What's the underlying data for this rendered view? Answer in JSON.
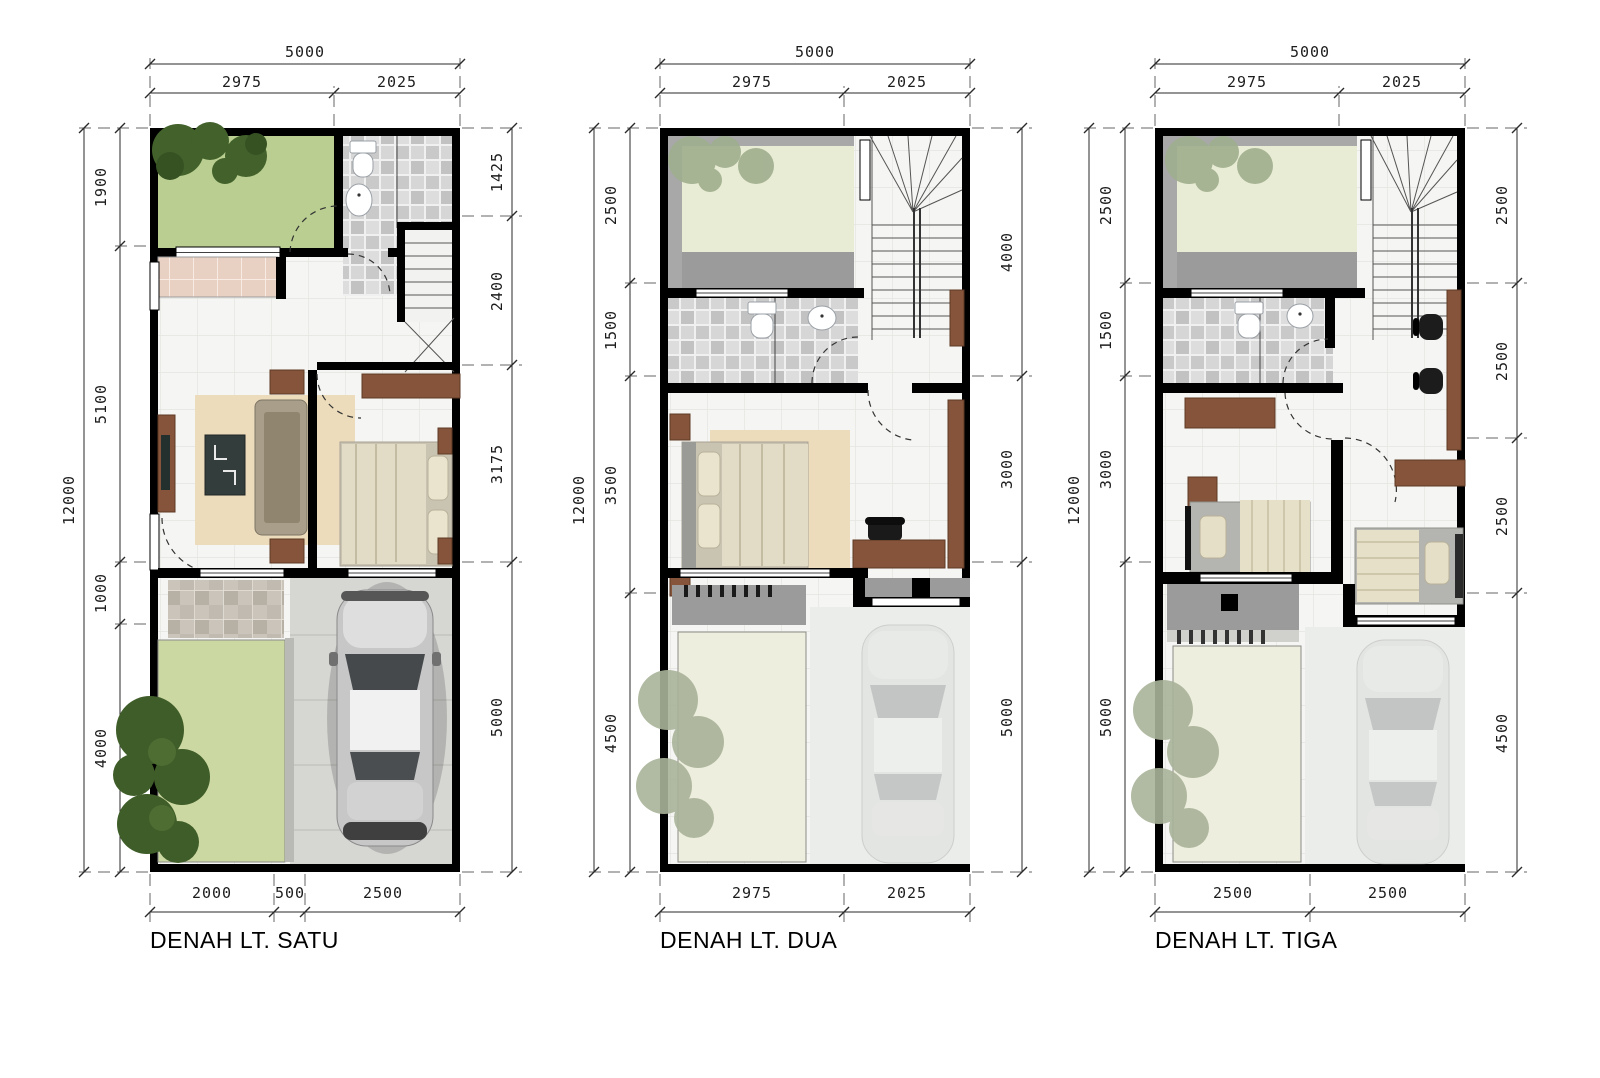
{
  "document": {
    "background": "#ffffff"
  },
  "colors": {
    "wall": "#000000",
    "dimension_line": "#2a2a2a",
    "grass": "#b9ce90",
    "grass_faded": "#e9ecd4",
    "tree": "#3f5d29",
    "tree_faded": "#a7b296",
    "wood": "#86543a",
    "carport": "#d6d7d3",
    "balcony_gray": "#9b9b9b",
    "rug": "#ecdcbb"
  },
  "plans": [
    {
      "title": "DENAH LT. SATU",
      "dims": {
        "top_total": "5000",
        "top": [
          "2975",
          "2025"
        ],
        "side_total": "12000",
        "left": [
          "1900",
          "5100",
          "1000",
          "4000"
        ],
        "right": [
          "1425",
          "2400",
          "3175",
          "5000"
        ],
        "bottom": [
          "2000",
          "500",
          "2500"
        ]
      }
    },
    {
      "title": "DENAH LT. DUA",
      "dims": {
        "top_total": "5000",
        "top": [
          "2975",
          "2025"
        ],
        "side_total": "12000",
        "left": [
          "2500",
          "1500",
          "3500",
          "4500"
        ],
        "right": [
          "4000",
          "3000",
          "5000"
        ],
        "bottom": [
          "2975",
          "2025"
        ]
      }
    },
    {
      "title": "DENAH LT. TIGA",
      "dims": {
        "top_total": "5000",
        "top": [
          "2975",
          "2025"
        ],
        "side_total": "12000",
        "left": [
          "2500",
          "1500",
          "3000",
          "5000"
        ],
        "right": [
          "2500",
          "2500",
          "2500",
          "4500"
        ],
        "bottom": [
          "2500",
          "2500"
        ]
      }
    }
  ]
}
